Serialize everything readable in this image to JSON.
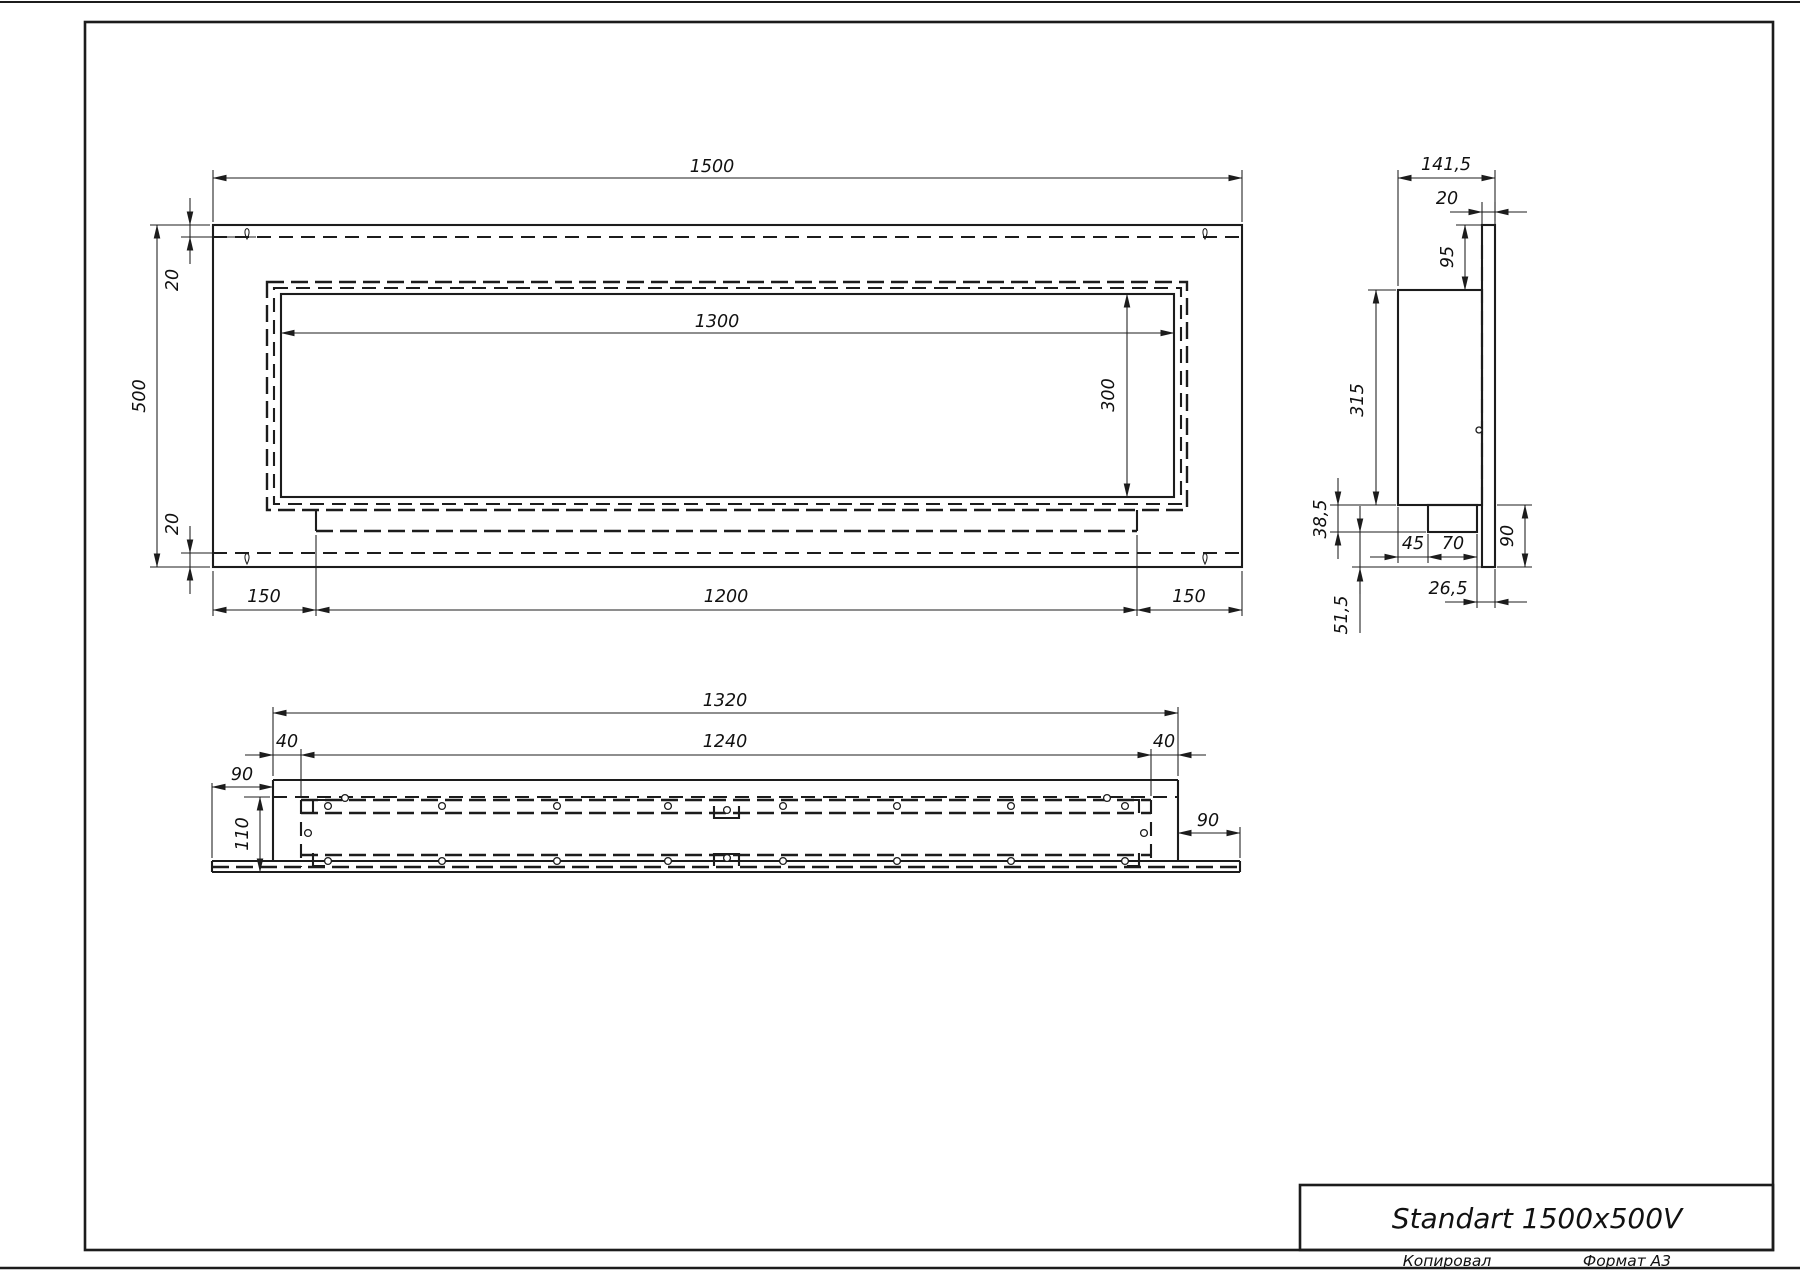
{
  "title_block": {
    "model": "Standart 1500x500V"
  },
  "sheet": {
    "copied": "Копировал",
    "format": "Формат А3"
  },
  "front": {
    "width": "1500",
    "height": "500",
    "inset_top": "20",
    "inset_bottom": "20",
    "opening_width": "1300",
    "opening_height": "300",
    "offset_left": "150",
    "burner_width": "1200",
    "offset_right": "150"
  },
  "side": {
    "depth": "141,5",
    "plate_thickness": "20",
    "plate_above": "95",
    "body_height": "315",
    "tray_drop": "38,5",
    "tray_offset": "45",
    "tray_width": "70",
    "plate_below": "90",
    "lip": "26,5",
    "gap": "51,5"
  },
  "bottom": {
    "outer_width": "1320",
    "opening_width": "1240",
    "inset_left": "40",
    "inset_right": "40",
    "tab_left": "90",
    "tab_right": "90",
    "depth": "110"
  }
}
